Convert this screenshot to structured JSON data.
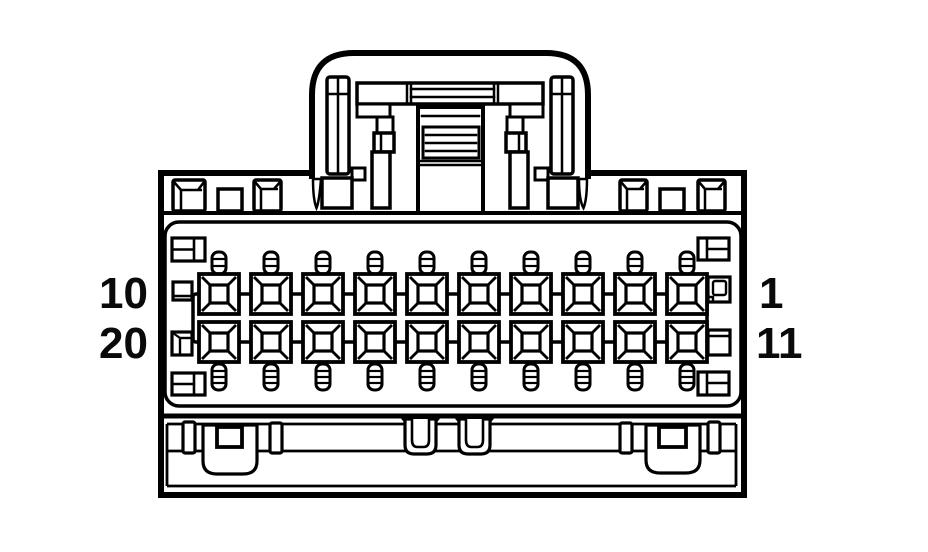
{
  "diagram": {
    "kind": "connector-pinout-face-view",
    "background": "#ffffff",
    "line_color": "#000000",
    "grid": {
      "rows": 2,
      "columns": 10
    },
    "labels": {
      "row1_left": "10",
      "row2_left": "20",
      "row1_right": "1",
      "row2_right": "11"
    }
  }
}
